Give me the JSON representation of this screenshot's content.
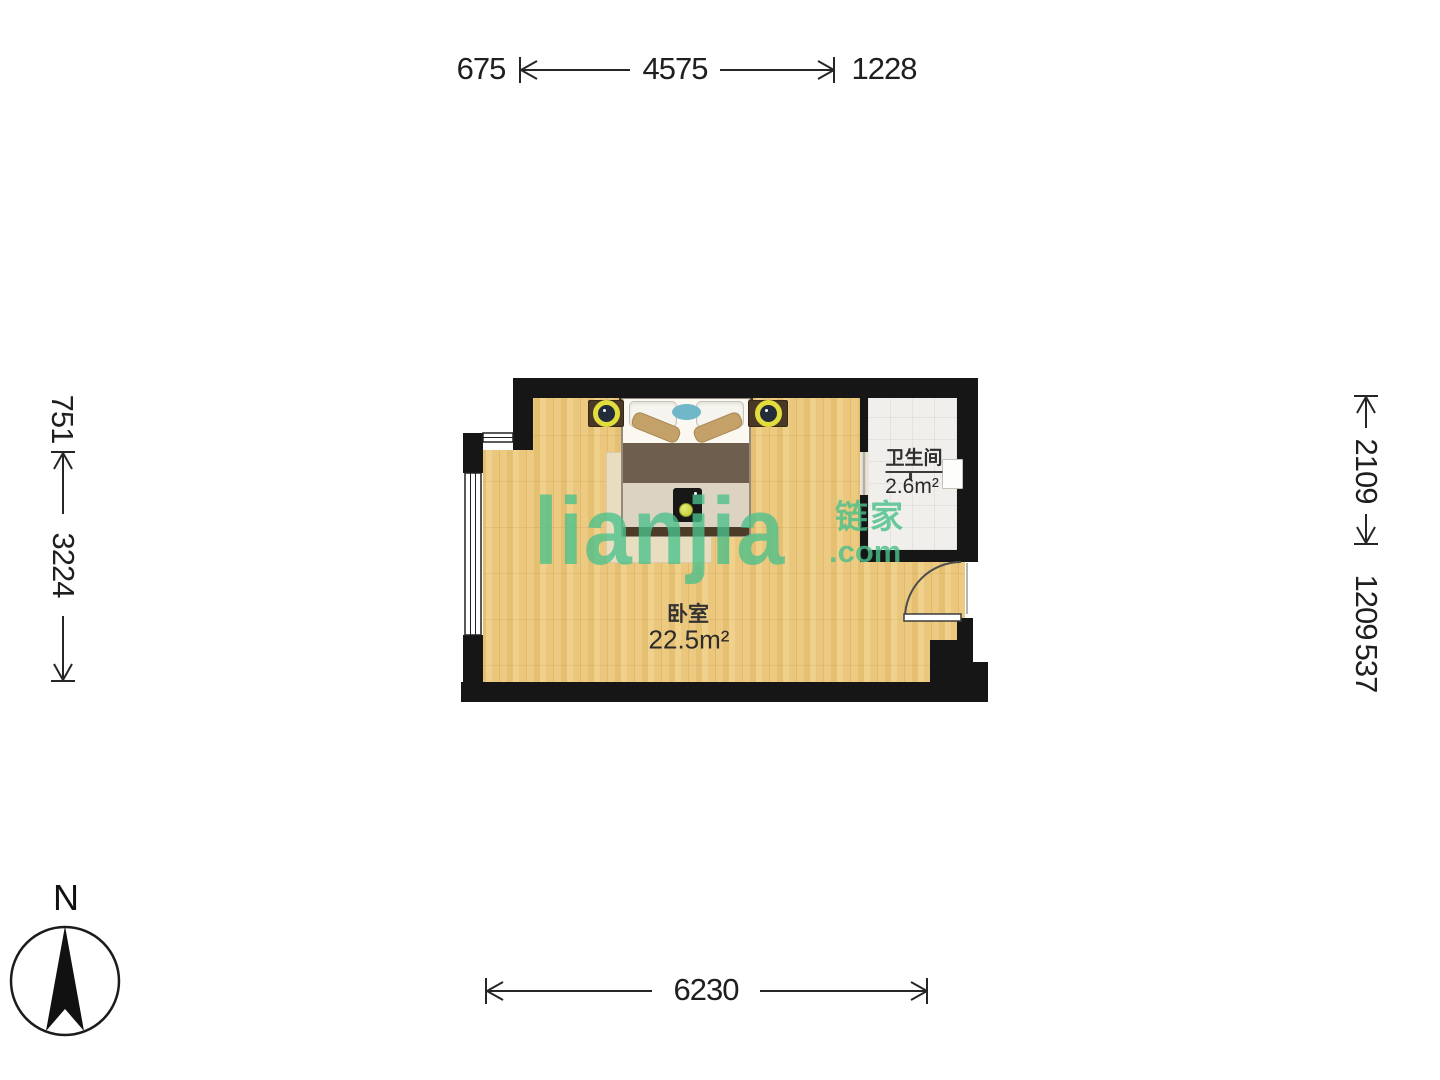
{
  "meta": {
    "type": "floorplan",
    "wall_color": "#161616",
    "wood_floor_color": "#e9c77f",
    "tile_floor_color": "#f0efeb",
    "watermark_color": "#4ac08a"
  },
  "dimensions": {
    "top": [
      {
        "value": "675"
      },
      {
        "value": "4575"
      },
      {
        "value": "1228"
      }
    ],
    "left": [
      {
        "value": "751"
      },
      {
        "value": "3224"
      }
    ],
    "right": [
      {
        "value": "2109"
      },
      {
        "value": "1209"
      },
      {
        "value": "537"
      }
    ],
    "bottom": [
      {
        "value": "6230"
      }
    ]
  },
  "rooms": {
    "bedroom": {
      "name": "卧室",
      "area": "22.5m²"
    },
    "bathroom": {
      "name": "卫生间",
      "area": "2.6m²"
    }
  },
  "compass": {
    "label": "N"
  },
  "watermark": {
    "brand": "lianjia",
    "cn": "链家",
    "domain": ".com"
  }
}
